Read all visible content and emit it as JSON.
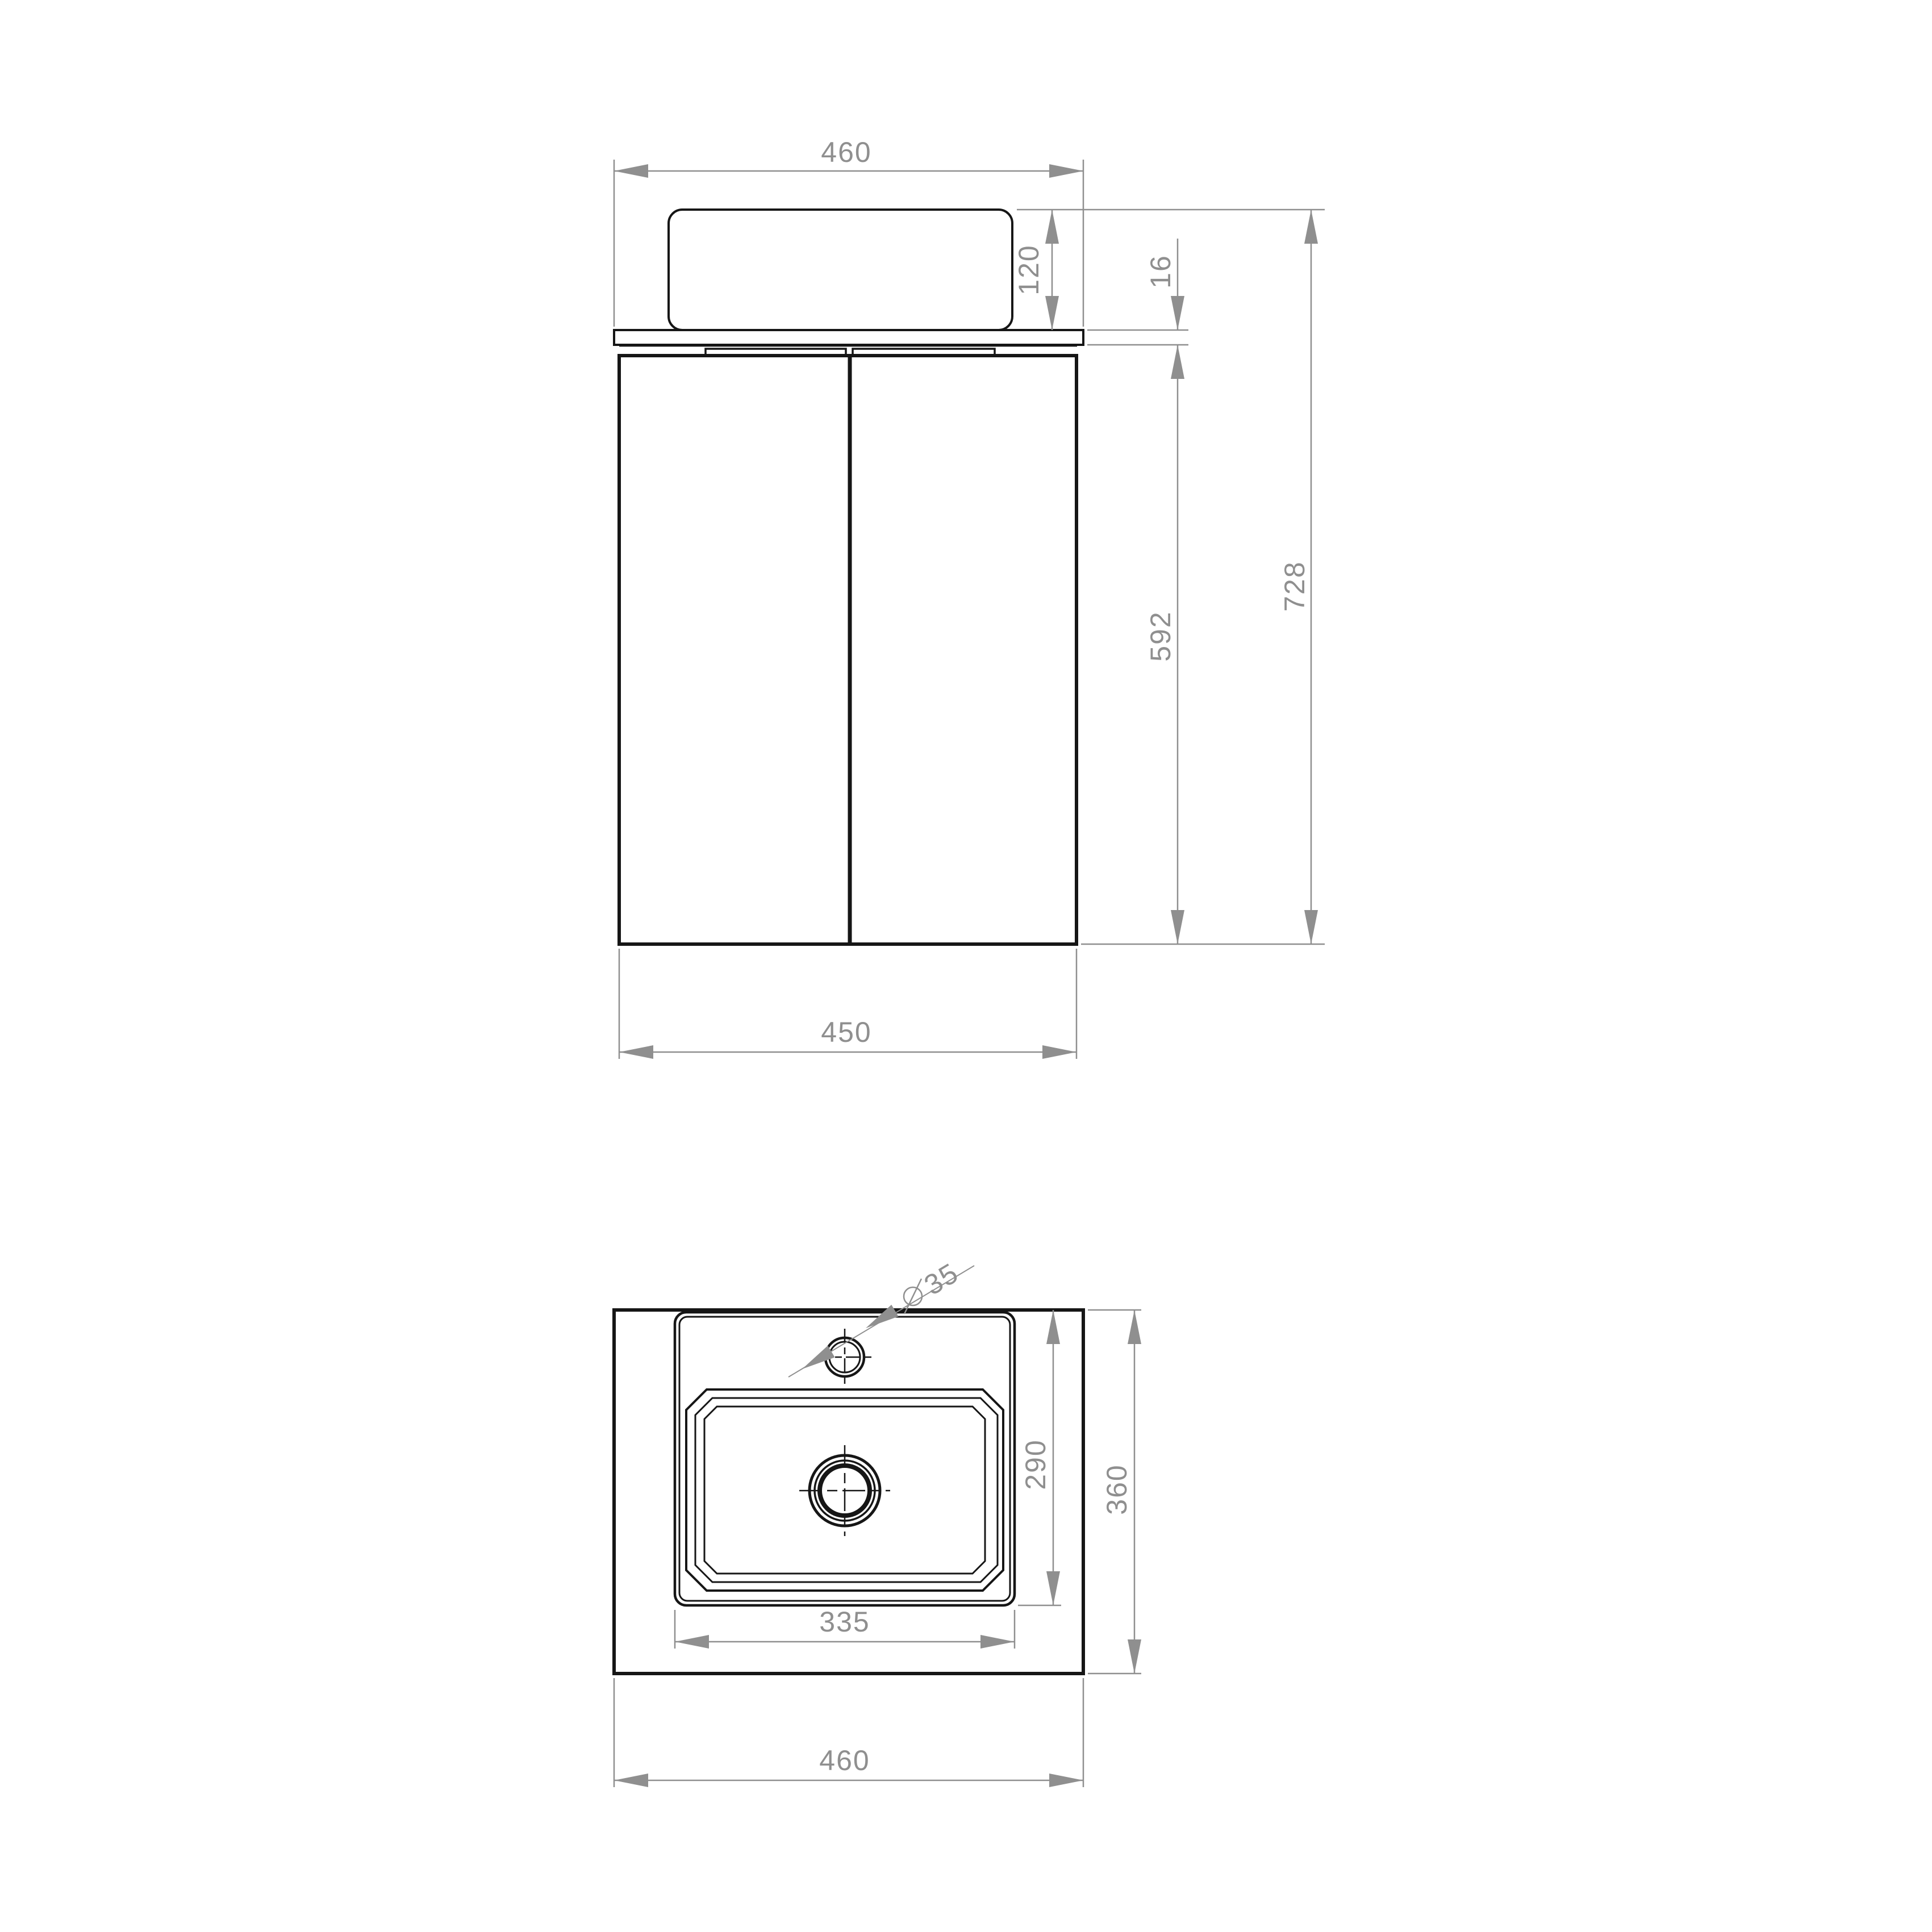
{
  "front_view": {
    "countertop_width": "460",
    "basin_height": "120",
    "countertop_thickness": "16",
    "cabinet_height": "592",
    "total_height": "728",
    "cabinet_width": "450"
  },
  "plan_view": {
    "tap_hole_diameter": "35",
    "basin_depth": "290",
    "countertop_depth": "360",
    "basin_width": "335",
    "countertop_width": "460"
  },
  "colors": {
    "linework": "#161616",
    "dimensions": "#8f8f8f",
    "background": "#ffffff"
  }
}
